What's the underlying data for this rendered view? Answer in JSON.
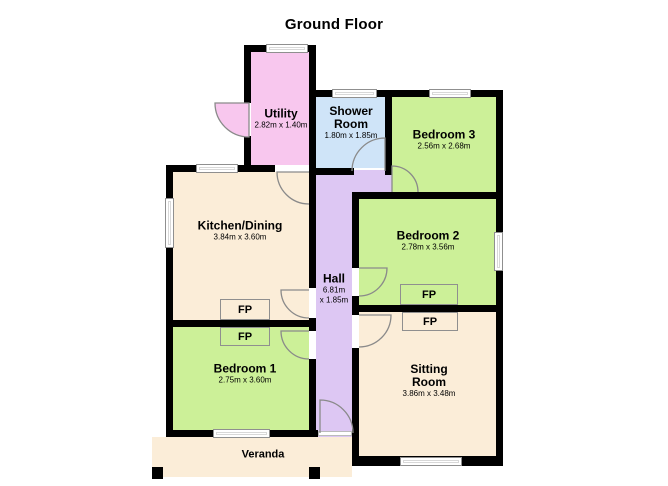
{
  "title": "Ground Floor",
  "fireplace_label": "FP",
  "colors": {
    "wall": "#000000",
    "door_stroke": "#8a8a8a",
    "window_fill": "#ffffff"
  },
  "rooms": {
    "utility": {
      "name": "Utility",
      "dims": "2.82m x 1.40m",
      "color": "#f8c7ee"
    },
    "shower_room": {
      "name_lines": [
        "Shower",
        "Room"
      ],
      "dims": "1.80m x 1.85m",
      "color": "#cfe4f8"
    },
    "bedroom3": {
      "name": "Bedroom 3",
      "dims": "2.56m x 2.68m",
      "color": "#ccf098"
    },
    "kitchen_dining": {
      "name": "Kitchen/Dining",
      "dims": "3.84m x 3.60m",
      "color": "#fbedd8"
    },
    "bedroom2": {
      "name": "Bedroom 2",
      "dims": "2.78m x 3.56m",
      "color": "#ccf098"
    },
    "hall": {
      "name": "Hall",
      "dims_lines": [
        "6.81m",
        "x 1.85m"
      ],
      "color": "#ddc7f3"
    },
    "bedroom1": {
      "name": "Bedroom 1",
      "dims": "2.75m x 3.60m",
      "color": "#ccf098"
    },
    "sitting_room": {
      "name_lines": [
        "Sitting",
        "Room"
      ],
      "dims": "3.86m x 3.48m",
      "color": "#fbedd8"
    },
    "veranda": {
      "name": "Veranda",
      "color": "#fbedd8"
    }
  }
}
